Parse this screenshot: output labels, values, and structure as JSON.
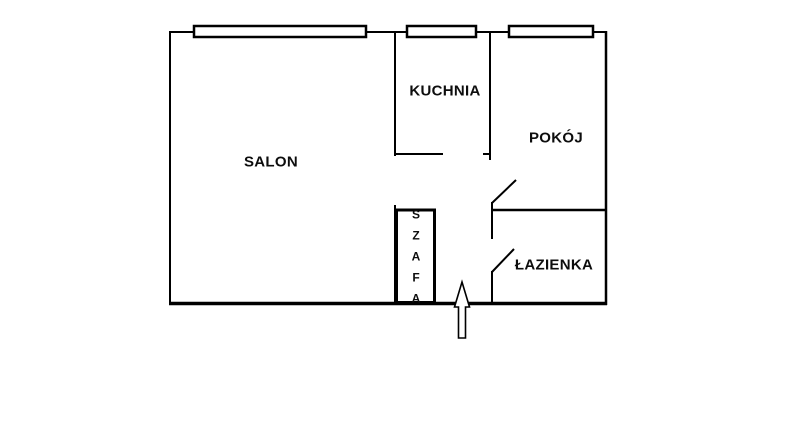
{
  "diagram": {
    "kind": "apartment-floor-plan",
    "colors": {
      "background": "#ffffff",
      "line": "#000000",
      "text": "#0d0d0d"
    },
    "rooms": {
      "salon": {
        "label": "SALON"
      },
      "kuchnia": {
        "label": "KUCHNIA"
      },
      "pokoj": {
        "label": "POKÓJ"
      },
      "lazienka": {
        "label": "ŁAZIENKA"
      },
      "szafa": {
        "label": "SZAFA"
      }
    },
    "entrance": {
      "symbol": "arrow",
      "direction": "up"
    },
    "window_count": 3,
    "interior_door_count": 2
  }
}
